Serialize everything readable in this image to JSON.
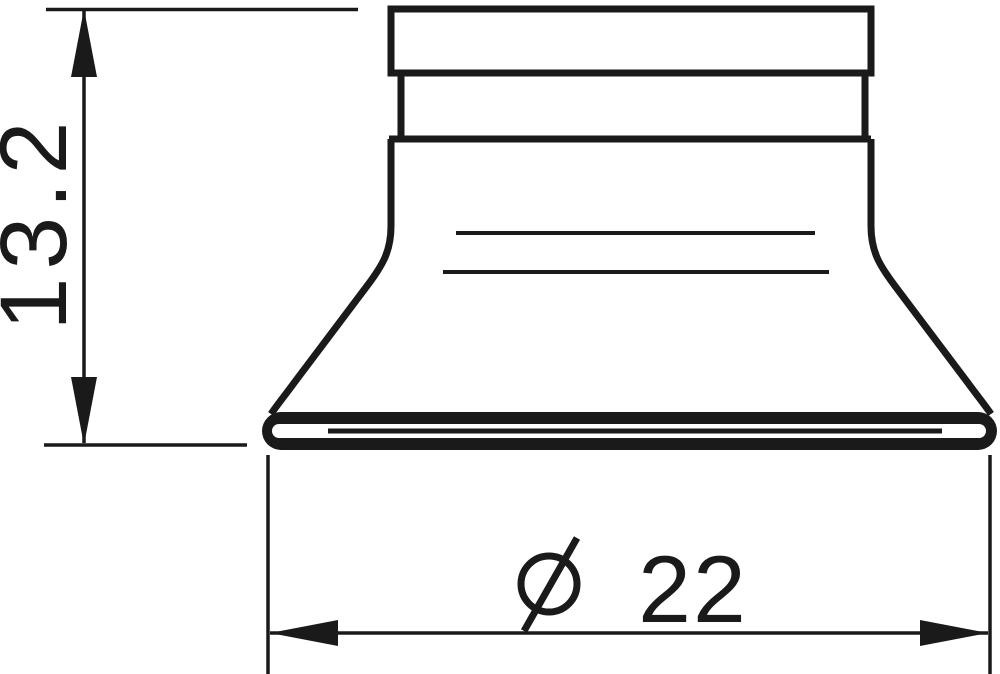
{
  "drawing": {
    "background": "#ffffff",
    "line_color": "#1a1a1a"
  },
  "dimensions": {
    "height": {
      "label": "13.2",
      "orientation": "vertical"
    },
    "diameter": {
      "symbol": "⌀",
      "label": "22",
      "orientation": "horizontal"
    }
  }
}
